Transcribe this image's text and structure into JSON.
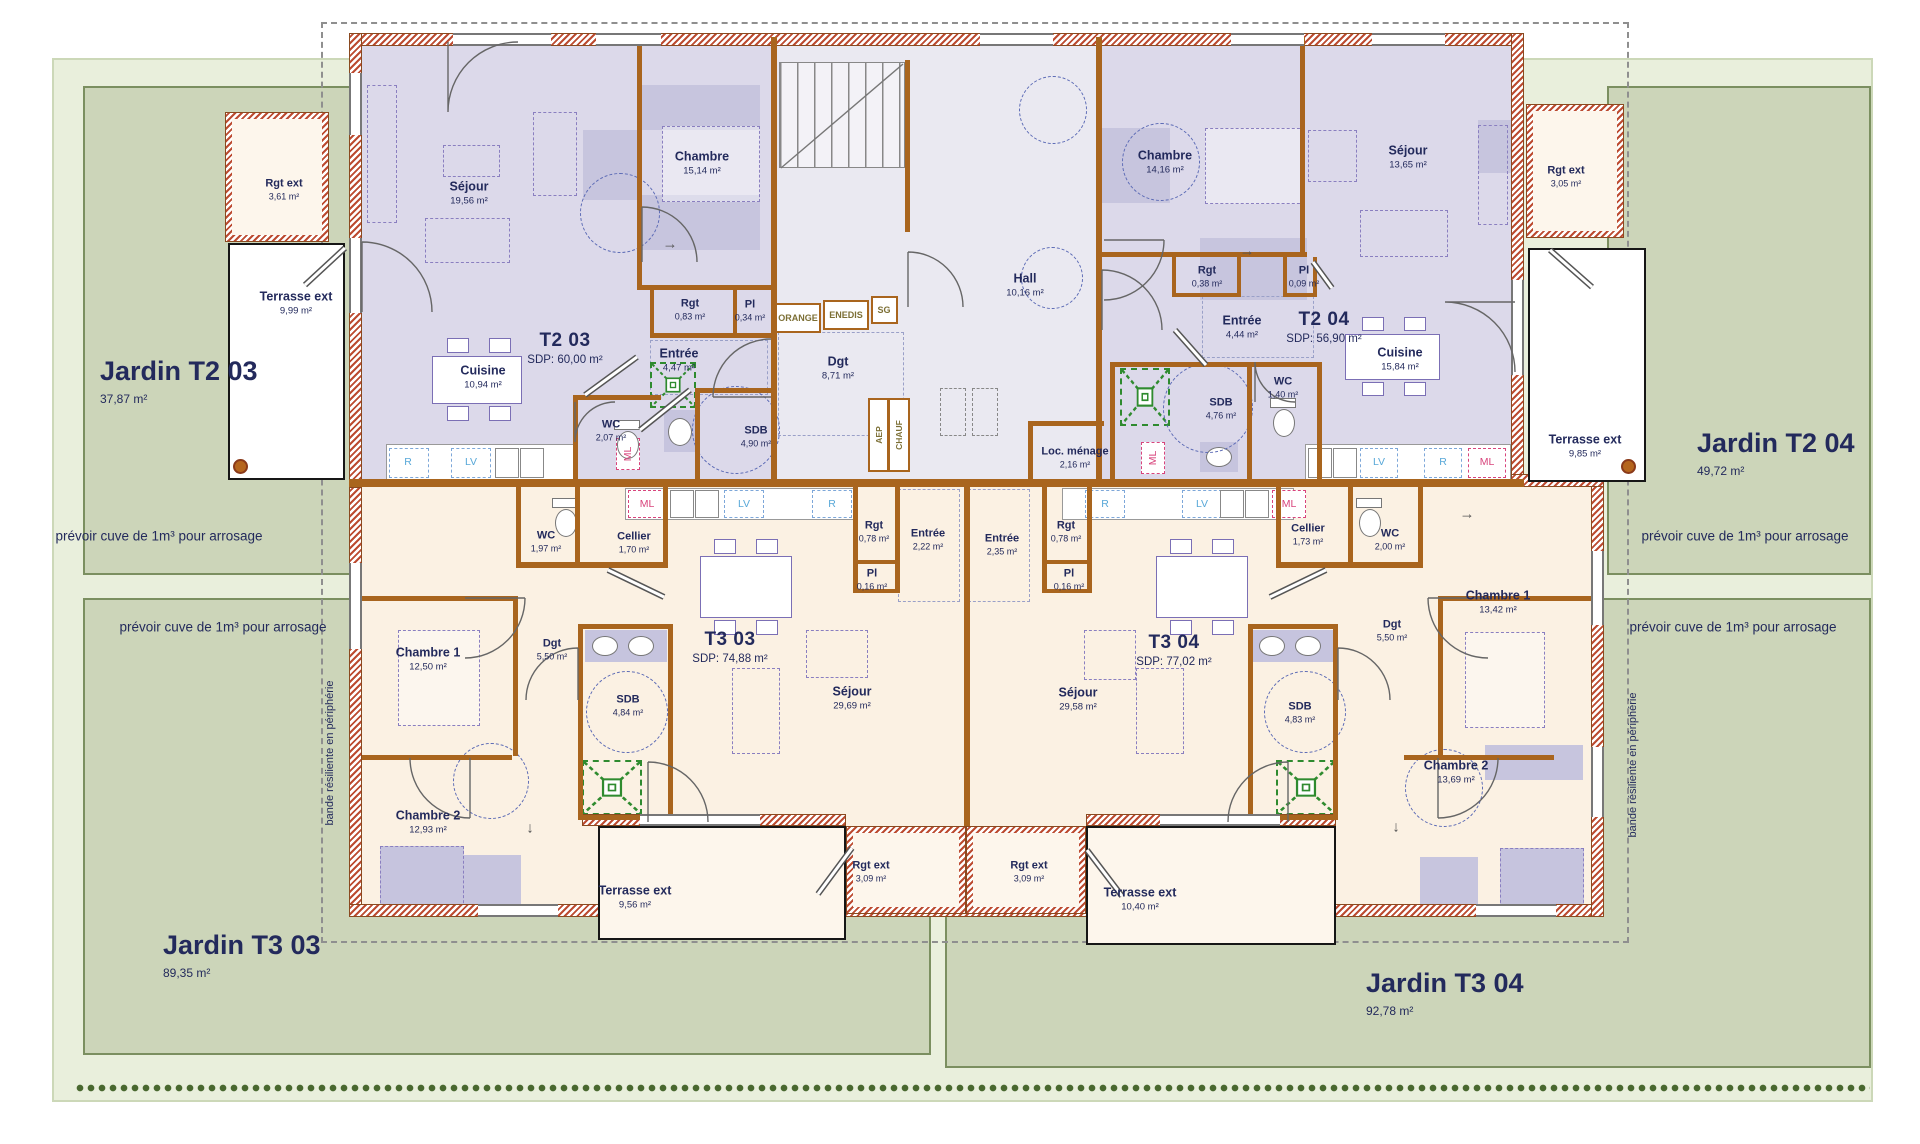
{
  "colors": {
    "garden": "#ccd5b9",
    "garden_frame": "#e9efdc",
    "hedge": "#49682f",
    "floor_t2": "#dcd9ea",
    "floor_t3": "#fbf1e3",
    "floor_common": "#eae9f1",
    "wall_brown": "#a9651e",
    "wall_hatch_red": "#bc4b31",
    "text_navy": "#232a5c",
    "furniture_purple": "#7b6fb5",
    "circle_blue": "#5b6ab5",
    "shower_green": "#2f8b2f",
    "ml_pink": "#d8447c",
    "lv_blue": "#58a8d8",
    "tech_olive": "#7c6f35"
  },
  "glyphs": {
    "arrow_right": "→",
    "arrow_down": "↓"
  },
  "annotations": {
    "cuve": "prévoir cuve de 1m³ pour arrosage",
    "bande": "bande résiliente en périphérie"
  },
  "gardens": {
    "t2_03": {
      "name": "Jardin T2 03",
      "area": "37,87 m²"
    },
    "t2_04": {
      "name": "Jardin T2 04",
      "area": "49,72 m²"
    },
    "t3_03": {
      "name": "Jardin T3 03",
      "area": "89,35 m²"
    },
    "t3_04": {
      "name": "Jardin T3 04",
      "area": "92,78 m²"
    }
  },
  "units": {
    "t2_03": {
      "name": "T2 03",
      "sdp": "SDP: 60,00 m²",
      "rooms": {
        "sejour": {
          "name": "Séjour",
          "area": "19,56 m²"
        },
        "chambre": {
          "name": "Chambre",
          "area": "15,14 m²"
        },
        "rgt": {
          "name": "Rgt",
          "area": "0,83 m²"
        },
        "pl": {
          "name": "Pl",
          "area": "0,34 m²"
        },
        "entree": {
          "name": "Entrée",
          "area": "4,47 m²"
        },
        "cuisine": {
          "name": "Cuisine",
          "area": "10,94 m²"
        },
        "wc": {
          "name": "WC",
          "area": "2,07 m²"
        },
        "sdb": {
          "name": "SDB",
          "area": "4,90 m²"
        }
      }
    },
    "t2_04": {
      "name": "T2 04",
      "sdp": "SDP: 56,90 m²",
      "rooms": {
        "chambre": {
          "name": "Chambre",
          "area": "14,16 m²"
        },
        "sejour": {
          "name": "Séjour",
          "area": "13,65 m²"
        },
        "rgt": {
          "name": "Rgt",
          "area": "0,38 m²"
        },
        "pl": {
          "name": "Pl",
          "area": "0,09 m²"
        },
        "entree": {
          "name": "Entrée",
          "area": "4,44 m²"
        },
        "cuisine": {
          "name": "Cuisine",
          "area": "15,84 m²"
        },
        "wc": {
          "name": "WC",
          "area": "1,40 m²"
        },
        "sdb": {
          "name": "SDB",
          "area": "4,76 m²"
        }
      }
    },
    "t3_03": {
      "name": "T3 03",
      "sdp": "SDP: 74,88 m²",
      "rooms": {
        "wc": {
          "name": "WC",
          "area": "1,97 m²"
        },
        "cellier": {
          "name": "Cellier",
          "area": "1,70 m²"
        },
        "rgt": {
          "name": "Rgt",
          "area": "0,78 m²"
        },
        "entree": {
          "name": "Entrée",
          "area": "2,22 m²"
        },
        "pl": {
          "name": "Pl",
          "area": "0,16 m²"
        },
        "chambre1": {
          "name": "Chambre 1",
          "area": "12,50 m²"
        },
        "dgt": {
          "name": "Dgt",
          "area": "5,50 m²"
        },
        "sdb": {
          "name": "SDB",
          "area": "4,84 m²"
        },
        "sejour": {
          "name": "Séjour",
          "area": "29,69 m²"
        },
        "chambre2": {
          "name": "Chambre 2",
          "area": "12,93 m²"
        }
      }
    },
    "t3_04": {
      "name": "T3 04",
      "sdp": "SDP: 77,02 m²",
      "rooms": {
        "entree": {
          "name": "Entrée",
          "area": "2,35 m²"
        },
        "rgt": {
          "name": "Rgt",
          "area": "0,78 m²"
        },
        "pl": {
          "name": "Pl",
          "area": "0,16 m²"
        },
        "cellier": {
          "name": "Cellier",
          "area": "1,73 m²"
        },
        "wc": {
          "name": "WC",
          "area": "2,00 m²"
        },
        "chambre1": {
          "name": "Chambre 1",
          "area": "13,42 m²"
        },
        "dgt": {
          "name": "Dgt",
          "area": "5,50 m²"
        },
        "sdb": {
          "name": "SDB",
          "area": "4,83 m²"
        },
        "sejour": {
          "name": "Séjour",
          "area": "29,58 m²"
        },
        "chambre2": {
          "name": "Chambre 2",
          "area": "13,69 m²"
        }
      }
    }
  },
  "common": {
    "hall": {
      "name": "Hall",
      "area": "10,16 m²"
    },
    "dgt": {
      "name": "Dgt",
      "area": "8,71 m²"
    },
    "loc_menage": {
      "name": "Loc. ménage",
      "area": "2,16 m²"
    },
    "orange": "ORANGE",
    "enedis": "ENEDIS",
    "sg": "SG",
    "aep": "AEP",
    "chauf": "CHAUF"
  },
  "exterior": {
    "rgt_tl": {
      "name": "Rgt ext",
      "area": "3,61 m²"
    },
    "terrasse_tl": {
      "name": "Terrasse ext",
      "area": "9,99 m²"
    },
    "rgt_tr": {
      "name": "Rgt ext",
      "area": "3,05 m²"
    },
    "terrasse_tr": {
      "name": "Terrasse ext",
      "area": "9,85 m²"
    },
    "terrasse_bl": {
      "name": "Terrasse ext",
      "area": "9,56 m²"
    },
    "rgt_bl": {
      "name": "Rgt ext",
      "area": "3,09 m²"
    },
    "rgt_br": {
      "name": "Rgt ext",
      "area": "3,09 m²"
    },
    "terrasse_br": {
      "name": "Terrasse ext",
      "area": "10,40 m²"
    }
  },
  "appliances": {
    "ml": "ML",
    "lv": "LV",
    "r": "R"
  }
}
